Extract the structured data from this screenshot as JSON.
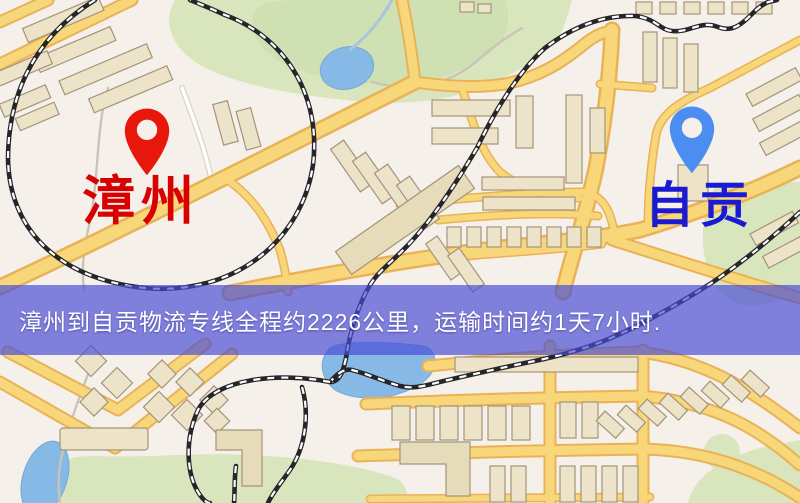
{
  "banner": {
    "text": "漳州到自贡物流专线全程约2226公里，运输时间约1天7小时.",
    "background_color": "#474bd6",
    "text_color": "#ffffff"
  },
  "origin": {
    "name": "漳州",
    "marker_color": "#e8170c",
    "label_color": "#d80000"
  },
  "destination": {
    "name": "自贡",
    "marker_color": "#4b8df0",
    "label_color": "#1a1ad2"
  },
  "route": {
    "distance_text": "约2226公里",
    "duration_text": "约1天7小时"
  }
}
